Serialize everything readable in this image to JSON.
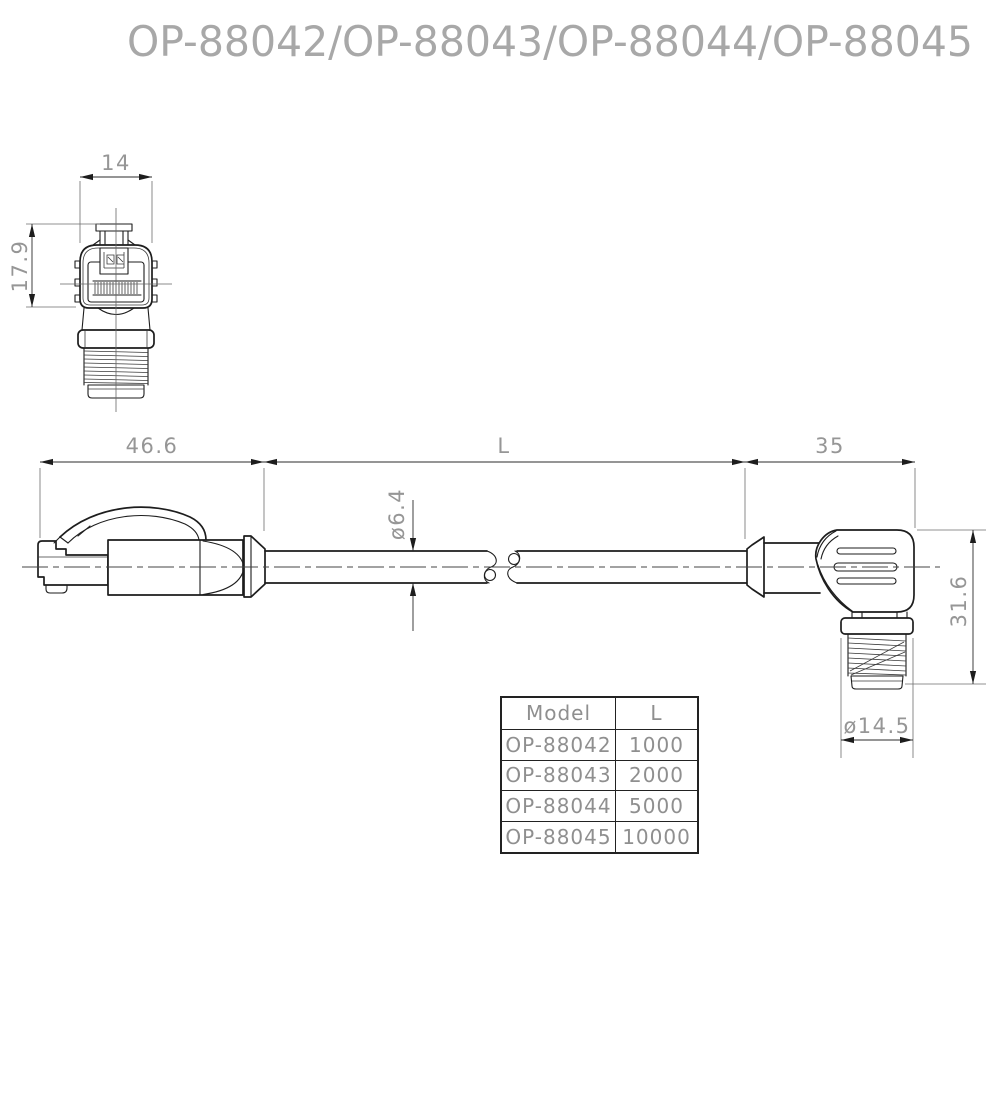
{
  "title": "OP-88042/OP-88043/OP-88044/OP-88045",
  "front_view": {
    "width_dim": "14",
    "height_dim": "17.9"
  },
  "side_view": {
    "left_connector_length_dim": "46.6",
    "cable_length_dim": "L",
    "right_connector_length_dim": "35",
    "cable_diameter_dim": "ø6.4",
    "right_connector_height_dim": "31.6",
    "thread_diameter_dim": "ø14.5"
  },
  "model_table": {
    "headers": [
      "Model",
      "L"
    ],
    "rows": [
      {
        "model": "OP-88042",
        "length": "1000"
      },
      {
        "model": "OP-88043",
        "length": "2000"
      },
      {
        "model": "OP-88044",
        "length": "5000"
      },
      {
        "model": "OP-88045",
        "length": "10000"
      }
    ]
  },
  "colors": {
    "background": "#ffffff",
    "line": "#1d1d1d",
    "dim_text": "#969696",
    "title_text": "#a8a8a8",
    "table_text": "#8f8f8f"
  }
}
